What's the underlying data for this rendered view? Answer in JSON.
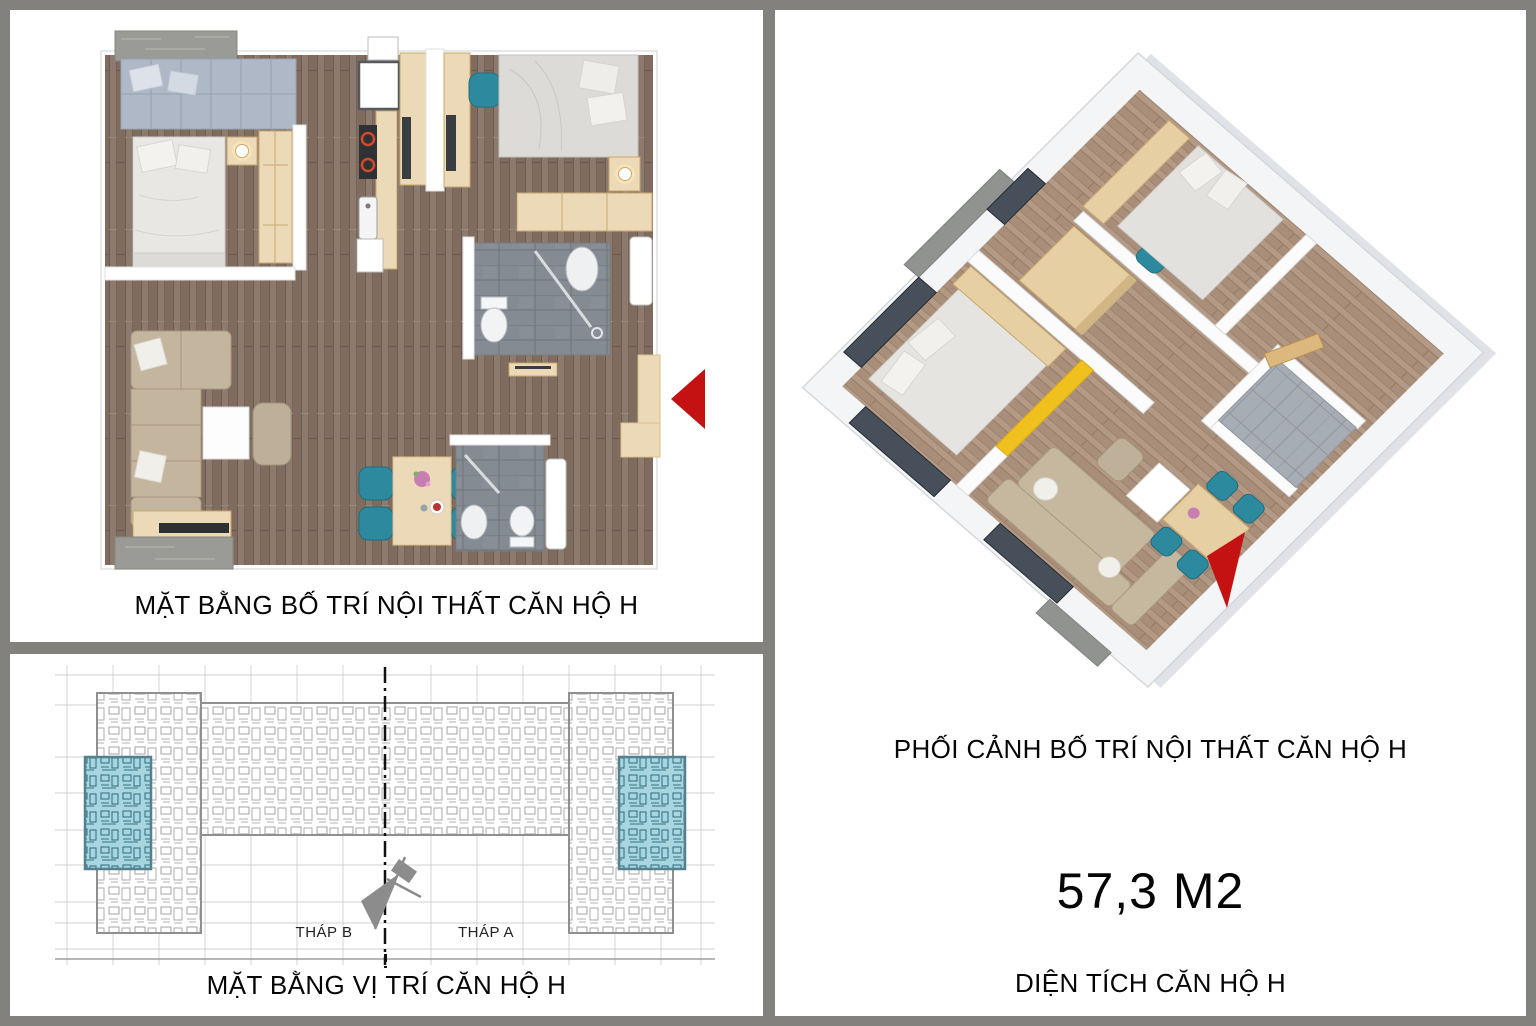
{
  "floor_plan_panel": {
    "title": "MẶT BẰNG BỐ TRÍ NỘI THẤT CĂN HỘ H"
  },
  "site_panel": {
    "title": "MẶT BẰNG VỊ TRÍ CĂN HỘ H",
    "tower_b_label": "THÁP B",
    "tower_a_label": "THÁP A"
  },
  "perspective_panel": {
    "title": "PHỐI CẢNH BỐ TRÍ NỘI THẤT CĂN HỘ H",
    "area_value": "57,3 M2",
    "area_caption": "DIỆN TÍCH CĂN HỘ H"
  },
  "icons": {
    "entrance_arrow_plan": "◀",
    "entrance_arrow_3d": "◤",
    "north_arrow": "compass"
  },
  "colors": {
    "frame_gray": "#82817d",
    "panel_bg": "#ffffff",
    "arrow_red": "#c41212",
    "accent_yellow": "#f0c11e",
    "teal_furniture": "#2d8a9e",
    "site_unit_highlight": "#a7d6e1",
    "wood_floor": "#8d7a6e",
    "wood_light": "#ecd9b8",
    "concrete": "#9a9a96",
    "bath_tile": "#848b92",
    "site_linework": "#8f8f8f"
  }
}
